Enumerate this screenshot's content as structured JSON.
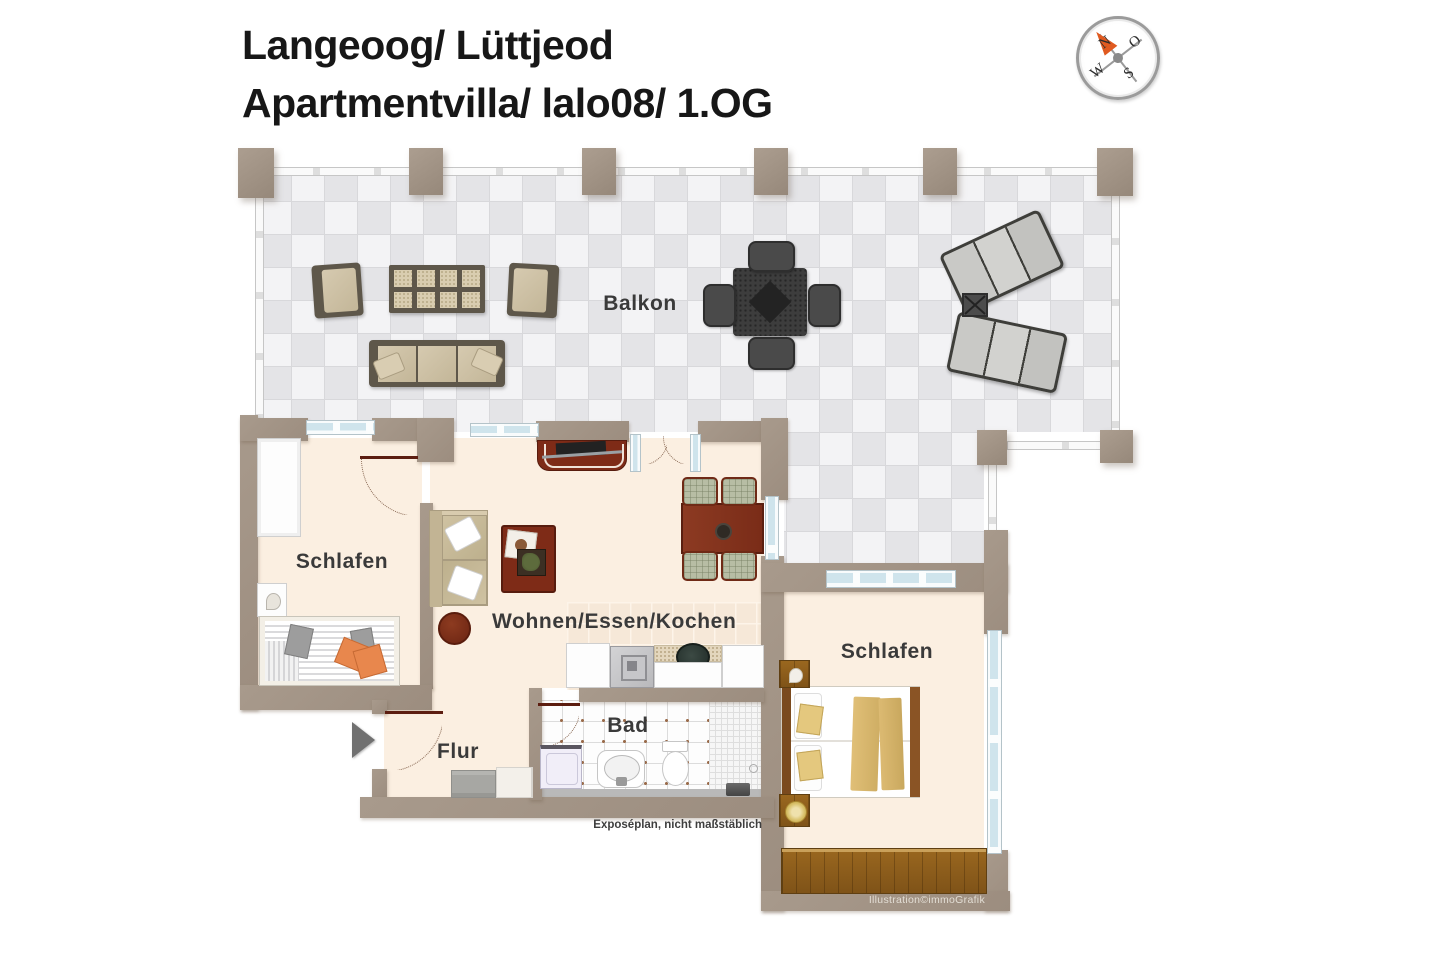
{
  "header": {
    "line1": "Langeoog/ Lüttjeod",
    "line2": "Apartmentvilla/ lalo08/ 1.OG"
  },
  "compass": {
    "north": "N",
    "east": "O",
    "south": "S",
    "west": "W"
  },
  "labels": {
    "balcony": "Balkon",
    "bedroom_left": "Schlafen",
    "living": "Wohnen/Essen/Kochen",
    "bedroom_right": "Schlafen",
    "bath": "Bad",
    "hall": "Flur"
  },
  "footnotes": {
    "scale": "Exposéplan, nicht maßstäblich",
    "credit": "Illustration©immoGrafik"
  },
  "colors": {
    "wall": "#a29386",
    "floor": "#fbefe1",
    "tile_light": "#f3f3f5",
    "tile_dark": "#e4e4e7",
    "wood_accent": "#7e2b17",
    "compass_arrow": "#e05a20"
  }
}
